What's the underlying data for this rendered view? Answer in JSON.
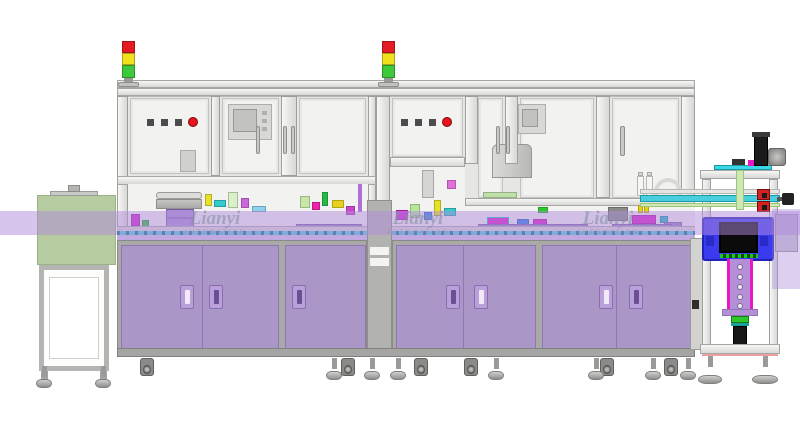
{
  "meta": {
    "description": "Side-elevation CAD rendering of a two-module automated assembly line: infeed tunnel unit on the left, two enclosed process modules with purple base cabinets and signal tower lights, shared conveyor band, and an outfeed pick station with a blue module on the right",
    "canvas": {
      "width": 800,
      "height": 438
    }
  },
  "watermark": {
    "brand": "Lianyi",
    "subtitle": "AUTOMATION",
    "instances": 3,
    "color": "#8a92a8"
  },
  "stack_lights": {
    "count": 2,
    "segment_order": [
      "red",
      "yellow",
      "green"
    ]
  },
  "machines": [
    {
      "name": "process-module-1",
      "square_buttons": 3,
      "round_red_button": 1,
      "hmi_panel": true,
      "bowl_feeder": true,
      "cabinet_door_handles": 3
    },
    {
      "name": "process-module-2",
      "square_buttons": 3,
      "round_red_button": 1,
      "hmi_panel": true,
      "bowl_feeder": false,
      "cabinet_door_handles": 4
    }
  ],
  "infeed": {
    "type": "tunnel-conveyor-unit"
  },
  "outfeed": {
    "type": "pick-station",
    "blue_module": true
  },
  "palette": {
    "background": "#ffffff",
    "frame_light": "#ebebe9",
    "frame_mid": "#d8d8d6",
    "frame_border": "#a6a6a4",
    "glass": "#f2f2f0",
    "body_gray": "#e6e6e4",
    "cabinet_body": "#a9a9a7",
    "cabinet_panel": "#ab96c8",
    "cabinet_seam": "#8f77b4",
    "handle_fill": "#b9a0d8",
    "handle_edge": "#8a6cb0",
    "handle_slit_dark": "#6b4f94",
    "handle_slit_light": "#f2eaf8",
    "band": "rgba(175,140,220,0.50)",
    "band_patch": "rgba(175,140,220,0.42)",
    "green_box": "#b6cb9f",
    "green_box_border": "#9ab385",
    "stack_red": "#e31b23",
    "stack_yellow": "#f0e01e",
    "stack_green": "#3ec93a",
    "button_dark": "#4c4c4c",
    "button_red": "#e8131b",
    "blue_unit": "#3a3aef",
    "blue_unit_border": "#2121b5",
    "conveyor_cyan": "#49cede",
    "conveyor_dash": "#1a6f86",
    "conveyor_silver": "#d8d8d6",
    "conveyor_purple": "#c0a8e0",
    "bracket_purple": "#b48fd6",
    "magenta": "#e818c8",
    "green_accent": "#1ed21e",
    "watermark": "#8a92a8"
  }
}
